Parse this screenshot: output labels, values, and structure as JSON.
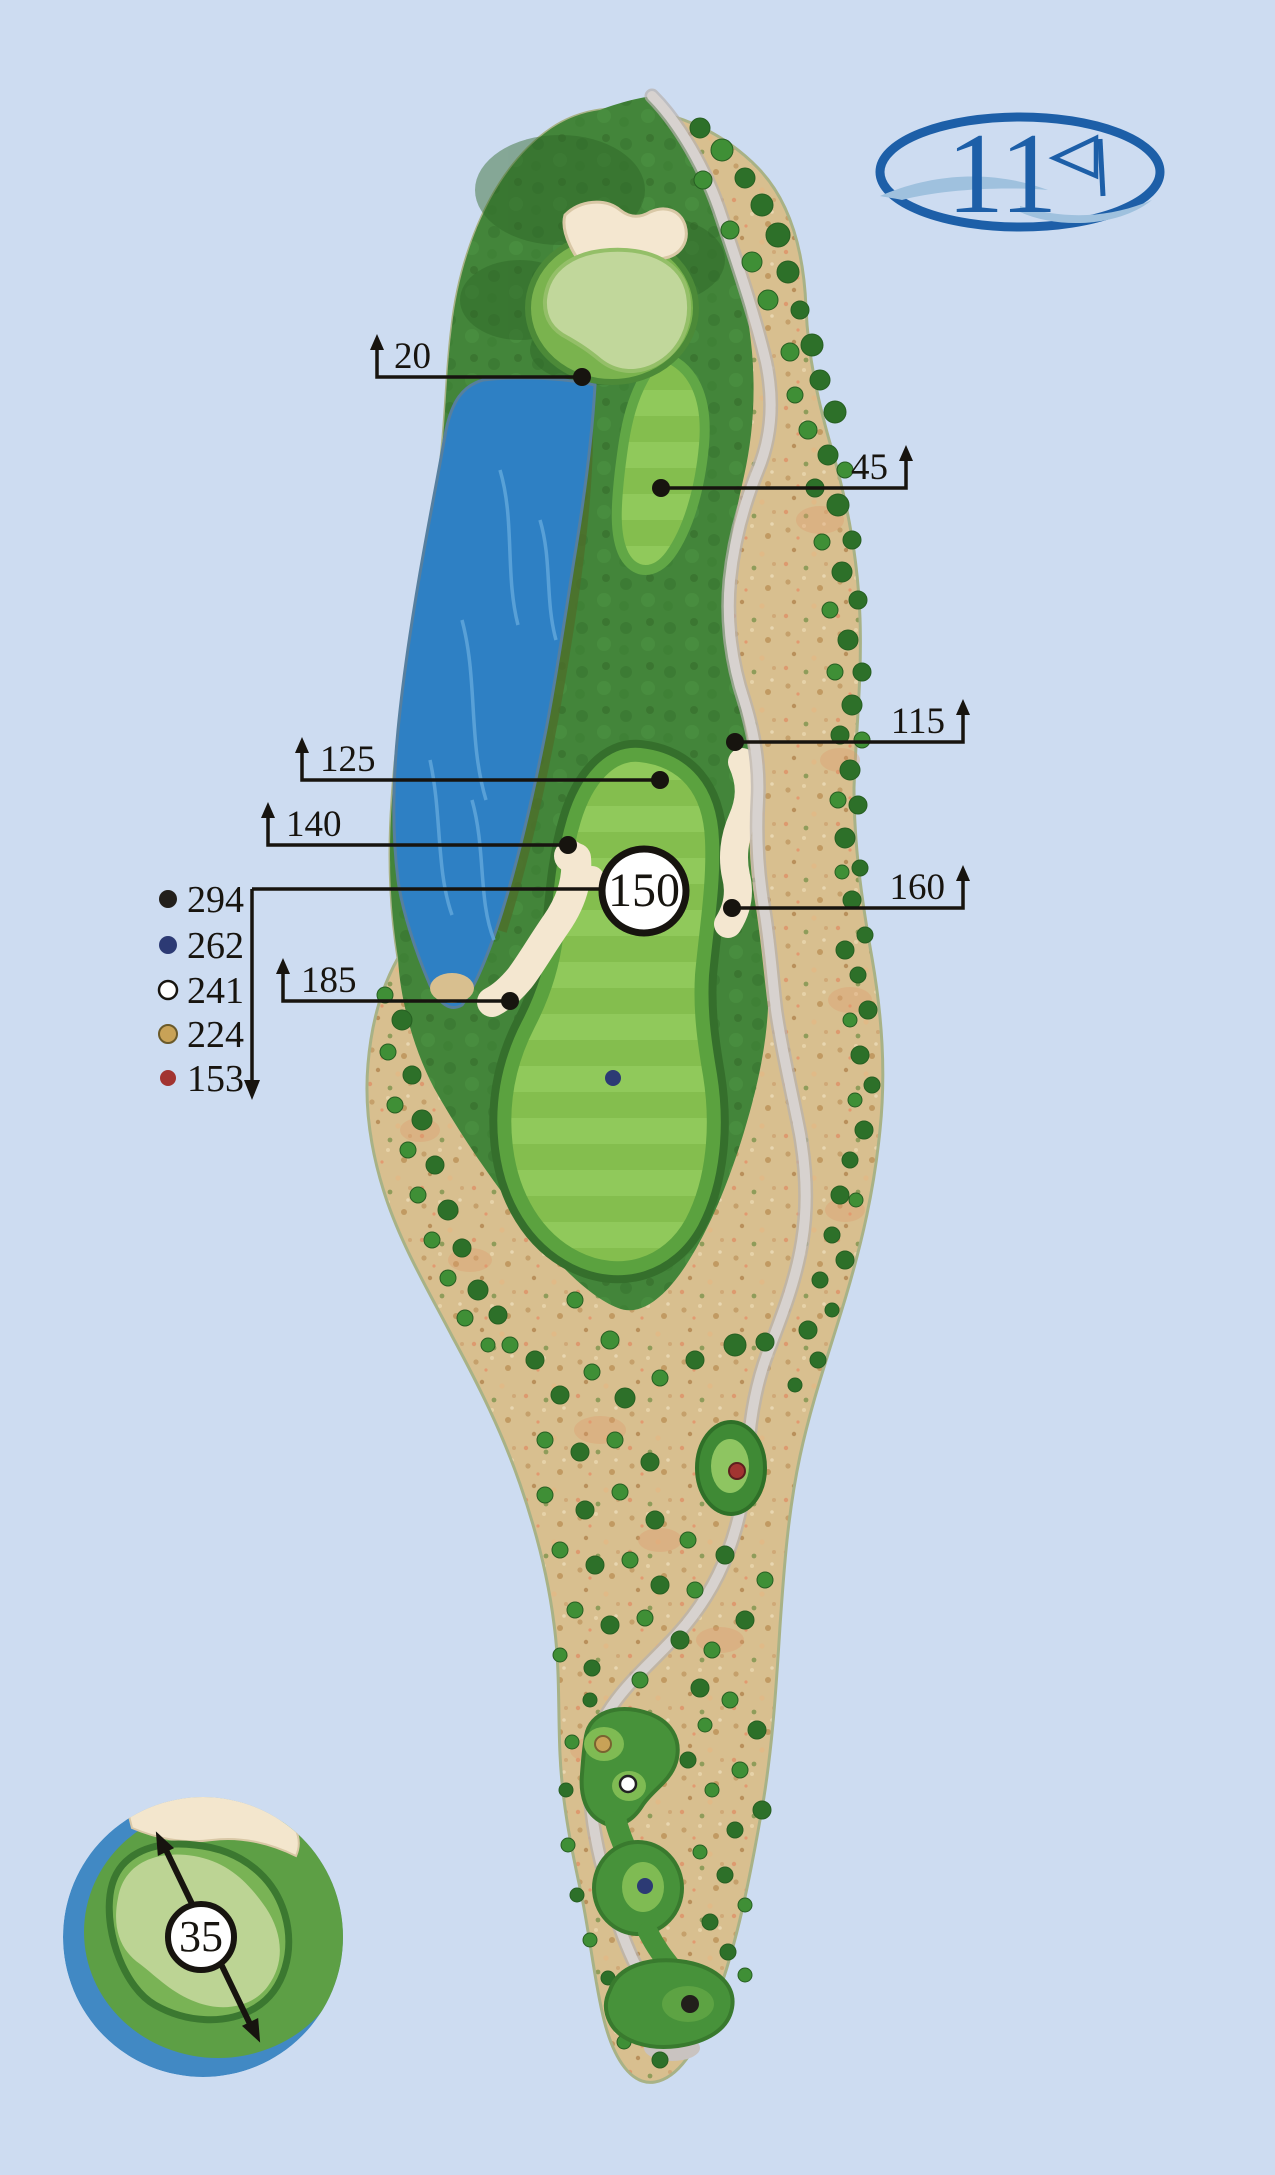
{
  "page": {
    "background_color": "#cddcf1"
  },
  "logo": {
    "hole_number": "11",
    "color": "#1d5fa8",
    "flag_icon": "pennant-flag"
  },
  "yardage_markers": [
    {
      "value": "20",
      "side": "left"
    },
    {
      "value": "45",
      "side": "right"
    },
    {
      "value": "115",
      "side": "right"
    },
    {
      "value": "125",
      "side": "left"
    },
    {
      "value": "140",
      "side": "left"
    },
    {
      "value": "160",
      "side": "right"
    },
    {
      "value": "185",
      "side": "left"
    }
  ],
  "center_marker": {
    "value": "150"
  },
  "tee_legend": {
    "items": [
      {
        "distance": "294",
        "tee": "black",
        "color": "#221f1b"
      },
      {
        "distance": "262",
        "tee": "blue",
        "color": "#2c3a74"
      },
      {
        "distance": "241",
        "tee": "white",
        "color": "#ffffff"
      },
      {
        "distance": "224",
        "tee": "gold",
        "color": "#c8a257"
      },
      {
        "distance": "153",
        "tee": "red",
        "color": "#a23431"
      }
    ]
  },
  "green_inset": {
    "depth_value": "35"
  },
  "map_colors": {
    "water": "#2e80c4",
    "fairway": "#8ac153",
    "rough": "#43853a",
    "desert": "#d8bf8f",
    "sand_bunker": "#f4e7d0",
    "green_surface": "#c1d79b",
    "cart_path": "#d7d2cf"
  }
}
